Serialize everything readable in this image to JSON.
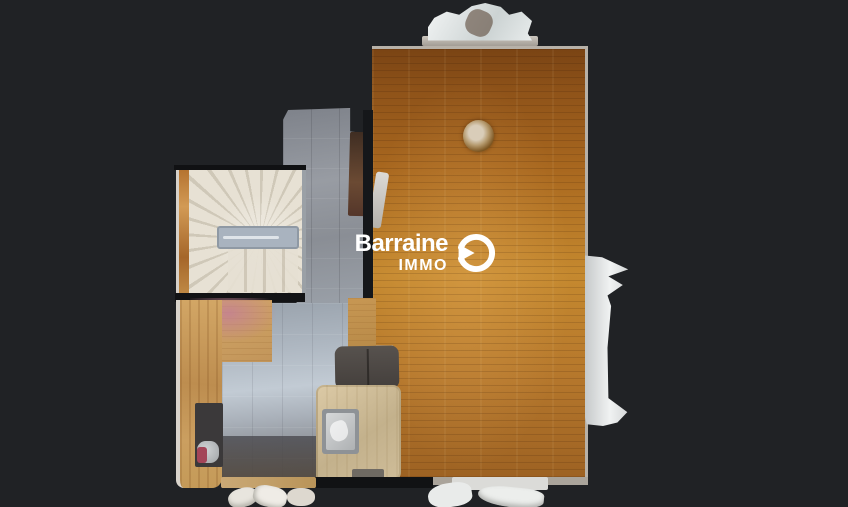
{
  "watermark": {
    "brand": "Barraine",
    "division": "IMMO",
    "icon": "play-circle-icon"
  },
  "colors": {
    "background": "#202225",
    "wall": "#b7b1a8",
    "seam": "#121315",
    "wood-dark": "#7a4414",
    "wood-mid": "#a9681f",
    "wood-light": "#c5892f",
    "tile-hall": "#8d9197",
    "tile-light": "#c2cbd4",
    "tile-dark": "#55565a",
    "stair-cream": "#e7e1d4",
    "stair-shade": "#cfc8b8",
    "railing": "#a9b3bf",
    "counter-wood": "#c79a5c",
    "island-wood": "#cfbd99",
    "couch": "#4b4744",
    "curtain": "#ecedec",
    "pink": "#c3899a",
    "appliance": "#3b393a",
    "logo-white": "#ffffff"
  }
}
